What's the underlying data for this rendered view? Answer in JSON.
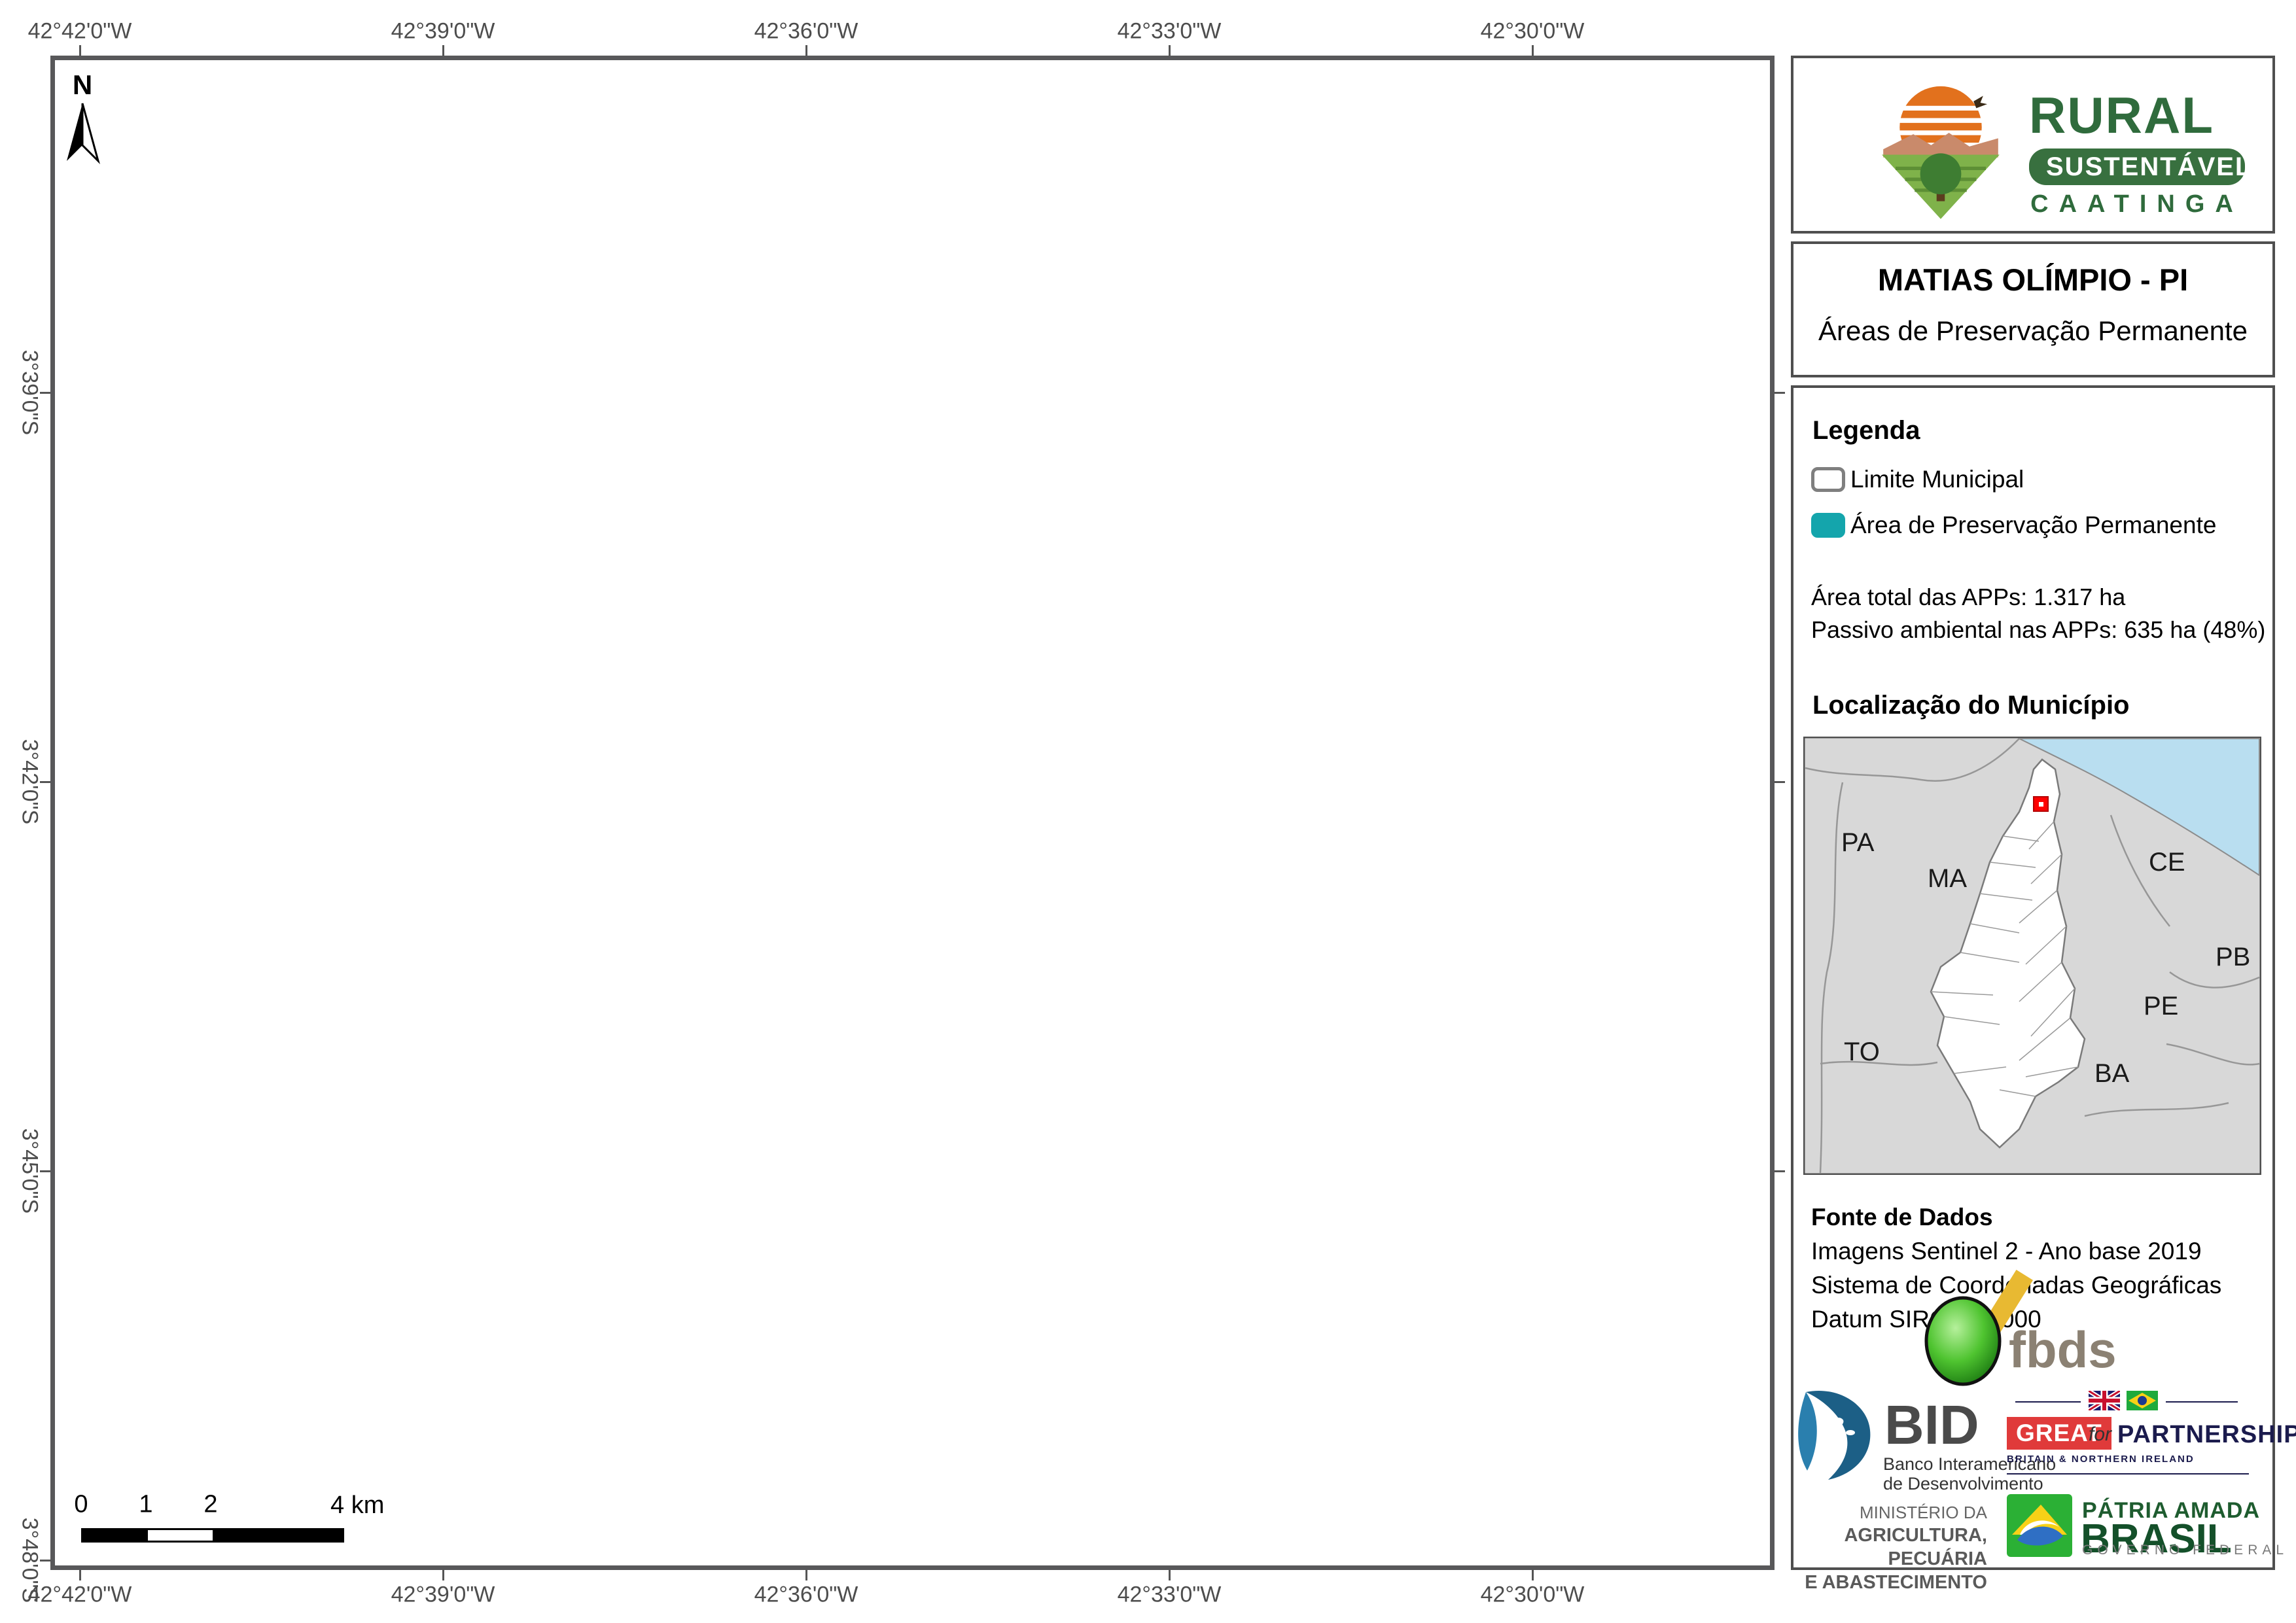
{
  "colors": {
    "app_teal": "#14A5AC",
    "municipality_fill": "#FBF3DA",
    "municipality_border": "#7F7F7F",
    "neighbor_line": "#8C8C8C",
    "frame": "#58585A",
    "label_gray": "#4D4D4D",
    "inset_land": "#D8D8D8",
    "inset_ocean": "#B9DEF0",
    "marker_red": "#FF0000",
    "brand_green": "#2F6B3C",
    "great_red": "#E03A3A",
    "partnership_navy": "#1B1B4D"
  },
  "map": {
    "north_label": "N",
    "coords_top": [
      "42°42'0\"W",
      "42°39'0\"W",
      "42°36'0\"W",
      "42°33'0\"W",
      "42°30'0\"W"
    ],
    "coords_bottom": [
      "42°42'0\"W",
      "42°39'0\"W",
      "42°36'0\"W",
      "42°33'0\"W",
      "42°30'0\"W"
    ],
    "coords_left": [
      "3°39'0\"S",
      "3°42'0\"S",
      "3°45'0\"S",
      "3°48'0\"S"
    ],
    "labels": {
      "milagres_1": "MILAGRES DO",
      "milagres_2": "MARANHÃO",
      "madeiro": "MADEIRO",
      "luzilandia": "LUZILÂNDIA",
      "brejo": "BREJO",
      "campo_1": "CAMPO LARGO",
      "campo_2": "DO PIAUÍ",
      "sao_joao_1": "SÃO JOÃO",
      "sao_joao_2": "DO ARRAIAL",
      "porto": "PORTO"
    },
    "scalebar": {
      "t0": "0",
      "t1": "1",
      "t2": "2",
      "t4": "4 km"
    }
  },
  "sidebar": {
    "brand": {
      "title": "RURAL",
      "subtitle": "SUSTENTÁVEL",
      "tagline": "CAATINGA"
    },
    "title": "MATIAS OLÍMPIO - PI",
    "subtitle": "Áreas de Preservação Permanente",
    "legend": {
      "heading": "Legenda",
      "item_limite": "Limite Municipal",
      "item_app": "Área de Preservação Permanente",
      "stat_total": "Área total das APPs: 1.317 ha",
      "stat_passivo": "Passivo ambiental nas APPs: 635 ha (48%)"
    },
    "location": {
      "heading": "Localização do Município",
      "states": {
        "pa": "PA",
        "ma": "MA",
        "to": "TO",
        "ce": "CE",
        "pb": "PB",
        "pe": "PE",
        "ba": "BA"
      }
    },
    "source": {
      "heading": "Fonte de Dados",
      "line1": "Imagens Sentinel 2 - Ano base 2019",
      "line2": "Sistema de Coordenadas Geográficas",
      "line3": "Datum SIRGAS 2000"
    },
    "logos": {
      "fbds": "fbds",
      "bid_name": "BID",
      "bid_sub1": "Banco Interamericano",
      "bid_sub2": "de Desenvolvimento",
      "great": "GREAT",
      "great_for": "for",
      "great_partnership": "PARTNERSHIP",
      "great_sub": "BRITAIN & NORTHERN IRELAND",
      "ministry_1": "MINISTÉRIO DA",
      "ministry_2": "AGRICULTURA, PECUÁRIA",
      "ministry_3": "E ABASTECIMENTO",
      "brasil_1": "PÁTRIA AMADA",
      "brasil_2": "BRASIL",
      "brasil_3": "GOVERNO FEDERAL"
    }
  }
}
